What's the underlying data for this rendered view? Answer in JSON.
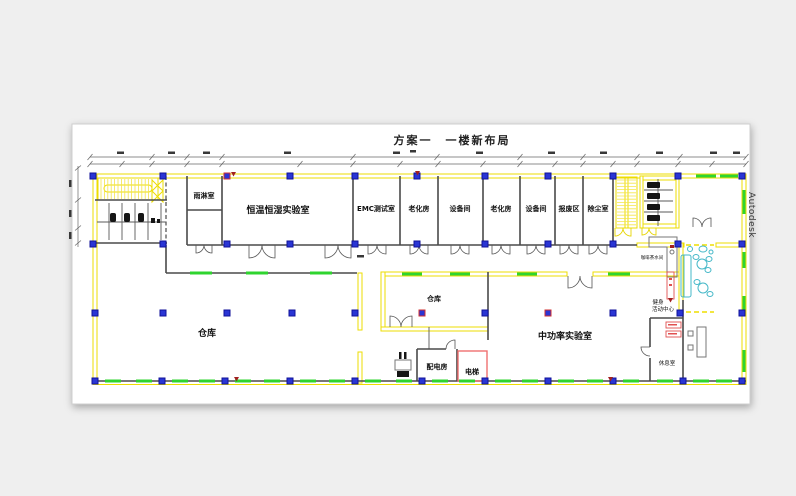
{
  "title": "方案一　一楼新布局",
  "watermark": "Autodesk",
  "rooms": {
    "rain_room": "雨淋室",
    "temp_humidity_lab": "恒温恒湿实验室",
    "emc_test_room": "EMC测试室",
    "aging_room_1": "老化房",
    "equipment_room_1": "设备间",
    "aging_room_2": "老化房",
    "equipment_room_2": "设备间",
    "scrap_area": "报废区",
    "dust_removal_room": "除尘室",
    "small_warehouse": "仓库",
    "large_warehouse": "仓库",
    "mid_power_lab": "中功率实验室",
    "power_distribution_room": "配电房",
    "elevator": "电梯",
    "coffee_pantry": "咖啡茶水间",
    "fitness_center_line1": "健身",
    "fitness_center_line2": "活动中心",
    "lounge": "休息室"
  },
  "colors": {
    "background": "#EFEFEF",
    "sheet": "#FFFFFF",
    "wall_yellow": "#EEDD00",
    "window_green": "#2FD42F",
    "column_blue": "#2A35D4",
    "wall_dark": "#4A4A4A",
    "accent_red": "#E05050",
    "marker_dark_red": "#A02020",
    "furniture_cyan": "#45B8C8"
  }
}
